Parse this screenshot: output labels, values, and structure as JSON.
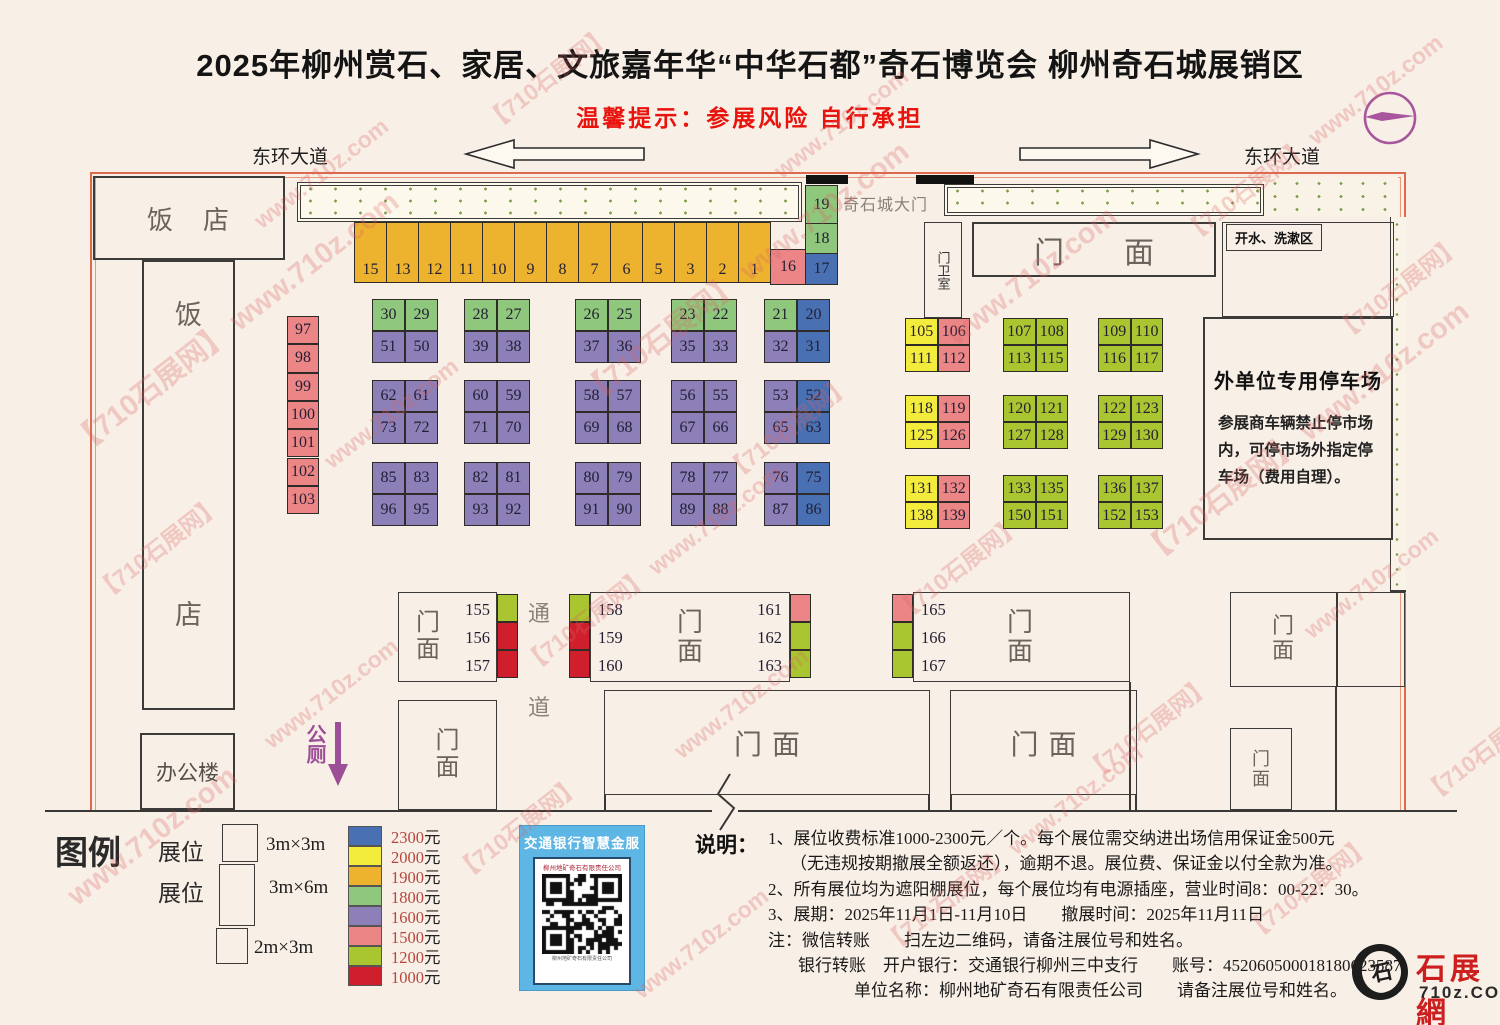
{
  "header": {
    "title": "2025年柳州赏石、家居、文旅嘉年华“中华石都”奇石博览会 柳州奇石城展销区",
    "subtitle": "温馨提示：参展风险 自行承担"
  },
  "roads": {
    "left": "东环大道",
    "right": "东环大道"
  },
  "labels": {
    "gate": "奇石城大门",
    "guard_room": "门卫室",
    "water_area": "开水、洗漱区",
    "men": "门",
    "mian": "面",
    "corridor_top": "通",
    "corridor_bottom": "道",
    "toilet": "公厕",
    "restaurant_fan": "饭",
    "restaurant_dian": "店",
    "restaurant_top": "饭　店",
    "office": "办公楼"
  },
  "parking": {
    "title": "外单位专用停车场",
    "body": "参展商车辆禁止停市场内，可停市场外指定停车场（费用自理）。"
  },
  "price_colors": {
    "2300": "#4a70b4",
    "2000": "#f3ec3d",
    "1900": "#edb32f",
    "1800": "#8fc77c",
    "1600": "#8d80b8",
    "1500": "#ec8686",
    "1200": "#a9c52f",
    "1000": "#d01f2c"
  },
  "booths": {
    "top_row": {
      "price": "1900",
      "numbers": [
        15,
        13,
        12,
        11,
        10,
        9,
        8,
        7,
        6,
        5,
        3,
        2,
        1
      ]
    },
    "corner": [
      {
        "n": 19,
        "p": "1800"
      },
      {
        "n": 18,
        "p": "1800"
      },
      {
        "n": 17,
        "p": "2300"
      },
      {
        "n": 16,
        "p": "1500"
      }
    ],
    "left_column": {
      "price": "1500",
      "numbers": [
        97,
        98,
        99,
        100,
        101,
        102,
        103
      ]
    },
    "center_blocks": [
      [
        [
          {
            "n": 30,
            "p": "1800"
          },
          {
            "n": 29,
            "p": "1800"
          },
          {
            "n": 51,
            "p": "1600"
          },
          {
            "n": 50,
            "p": "1600"
          }
        ],
        [
          {
            "n": 28,
            "p": "1800"
          },
          {
            "n": 27,
            "p": "1800"
          },
          {
            "n": 39,
            "p": "1600"
          },
          {
            "n": 38,
            "p": "1600"
          }
        ],
        [
          {
            "n": 26,
            "p": "1800"
          },
          {
            "n": 25,
            "p": "1800"
          },
          {
            "n": 37,
            "p": "1600"
          },
          {
            "n": 36,
            "p": "1600"
          }
        ],
        [
          {
            "n": 23,
            "p": "1800"
          },
          {
            "n": 22,
            "p": "1800"
          },
          {
            "n": 35,
            "p": "1600"
          },
          {
            "n": 33,
            "p": "1600"
          }
        ],
        [
          {
            "n": 21,
            "p": "1800"
          },
          {
            "n": 20,
            "p": "2300"
          },
          {
            "n": 32,
            "p": "1600"
          },
          {
            "n": 31,
            "p": "2300"
          }
        ]
      ],
      [
        [
          {
            "n": 62,
            "p": "1600"
          },
          {
            "n": 61,
            "p": "1600"
          },
          {
            "n": 73,
            "p": "1600"
          },
          {
            "n": 72,
            "p": "1600"
          }
        ],
        [
          {
            "n": 60,
            "p": "1600"
          },
          {
            "n": 59,
            "p": "1600"
          },
          {
            "n": 71,
            "p": "1600"
          },
          {
            "n": 70,
            "p": "1600"
          }
        ],
        [
          {
            "n": 58,
            "p": "1600"
          },
          {
            "n": 57,
            "p": "1600"
          },
          {
            "n": 69,
            "p": "1600"
          },
          {
            "n": 68,
            "p": "1600"
          }
        ],
        [
          {
            "n": 56,
            "p": "1600"
          },
          {
            "n": 55,
            "p": "1600"
          },
          {
            "n": 67,
            "p": "1600"
          },
          {
            "n": 66,
            "p": "1600"
          }
        ],
        [
          {
            "n": 53,
            "p": "1600"
          },
          {
            "n": 52,
            "p": "2300"
          },
          {
            "n": 65,
            "p": "1600"
          },
          {
            "n": 63,
            "p": "2300"
          }
        ]
      ],
      [
        [
          {
            "n": 85,
            "p": "1600"
          },
          {
            "n": 83,
            "p": "1600"
          },
          {
            "n": 96,
            "p": "1600"
          },
          {
            "n": 95,
            "p": "1600"
          }
        ],
        [
          {
            "n": 82,
            "p": "1600"
          },
          {
            "n": 81,
            "p": "1600"
          },
          {
            "n": 93,
            "p": "1600"
          },
          {
            "n": 92,
            "p": "1600"
          }
        ],
        [
          {
            "n": 80,
            "p": "1600"
          },
          {
            "n": 79,
            "p": "1600"
          },
          {
            "n": 91,
            "p": "1600"
          },
          {
            "n": 90,
            "p": "1600"
          }
        ],
        [
          {
            "n": 78,
            "p": "1600"
          },
          {
            "n": 77,
            "p": "1600"
          },
          {
            "n": 89,
            "p": "1600"
          },
          {
            "n": 88,
            "p": "1600"
          }
        ],
        [
          {
            "n": 76,
            "p": "1600"
          },
          {
            "n": 75,
            "p": "2300"
          },
          {
            "n": 87,
            "p": "1600"
          },
          {
            "n": 86,
            "p": "2300"
          }
        ]
      ]
    ],
    "right_blocks": [
      [
        [
          {
            "n": 105,
            "p": "2000"
          },
          {
            "n": 106,
            "p": "1500"
          },
          {
            "n": 111,
            "p": "2000"
          },
          {
            "n": 112,
            "p": "1500"
          }
        ],
        [
          {
            "n": 107,
            "p": "1200"
          },
          {
            "n": 108,
            "p": "1200"
          },
          {
            "n": 113,
            "p": "1200"
          },
          {
            "n": 115,
            "p": "1200"
          }
        ],
        [
          {
            "n": 109,
            "p": "1200"
          },
          {
            "n": 110,
            "p": "1200"
          },
          {
            "n": 116,
            "p": "1200"
          },
          {
            "n": 117,
            "p": "1200"
          }
        ]
      ],
      [
        [
          {
            "n": 118,
            "p": "2000"
          },
          {
            "n": 119,
            "p": "1500"
          },
          {
            "n": 125,
            "p": "2000"
          },
          {
            "n": 126,
            "p": "1500"
          }
        ],
        [
          {
            "n": 120,
            "p": "1200"
          },
          {
            "n": 121,
            "p": "1200"
          },
          {
            "n": 127,
            "p": "1200"
          },
          {
            "n": 128,
            "p": "1200"
          }
        ],
        [
          {
            "n": 122,
            "p": "1200"
          },
          {
            "n": 123,
            "p": "1200"
          },
          {
            "n": 129,
            "p": "1200"
          },
          {
            "n": 130,
            "p": "1200"
          }
        ]
      ],
      [
        [
          {
            "n": 131,
            "p": "2000"
          },
          {
            "n": 132,
            "p": "1500"
          },
          {
            "n": 138,
            "p": "2000"
          },
          {
            "n": 139,
            "p": "1500"
          }
        ],
        [
          {
            "n": 133,
            "p": "1200"
          },
          {
            "n": 135,
            "p": "1200"
          },
          {
            "n": 150,
            "p": "1200"
          },
          {
            "n": 151,
            "p": "1200"
          }
        ],
        [
          {
            "n": 136,
            "p": "1200"
          },
          {
            "n": 137,
            "p": "1200"
          },
          {
            "n": 152,
            "p": "1200"
          },
          {
            "n": 153,
            "p": "1200"
          }
        ]
      ]
    ]
  },
  "shops": {
    "row_a": {
      "numbers": [
        155,
        156,
        157
      ],
      "chips": [
        "1200",
        "1000",
        "1000"
      ]
    },
    "row_b_left": {
      "numbers": [
        158,
        159,
        160
      ],
      "chips": [
        "1200",
        "1000",
        "1000"
      ]
    },
    "row_b_right": {
      "numbers": [
        161,
        162,
        163
      ],
      "chips": [
        "1500",
        "1200",
        "1200"
      ]
    },
    "row_c": {
      "numbers": [
        165,
        166,
        167
      ],
      "chips": [
        "1500",
        "1200",
        "1200"
      ]
    }
  },
  "legend": {
    "title": "图例",
    "sizes": [
      {
        "label": "展位",
        "dims": "3m×3m"
      },
      {
        "label": "展位",
        "dims": "3m×6m"
      },
      {
        "label": "",
        "dims": "2m×3m"
      }
    ],
    "prices": [
      {
        "value": "2300",
        "unit": "元",
        "price": "2300"
      },
      {
        "value": "2000",
        "unit": "元",
        "price": "2000"
      },
      {
        "value": "1900",
        "unit": "元",
        "price": "1900"
      },
      {
        "value": "1800",
        "unit": "元",
        "price": "1800"
      },
      {
        "value": "1600",
        "unit": "元",
        "price": "1600"
      },
      {
        "value": "1500",
        "unit": "元",
        "price": "1500"
      },
      {
        "value": "1200",
        "unit": "元",
        "price": "1200"
      },
      {
        "value": "1000",
        "unit": "元",
        "price": "1000"
      }
    ]
  },
  "qr": {
    "header": "交通银行智慧金服",
    "company": "柳州地矿奇石有限责任公司",
    "caption": "柳州地矿奇石有限责任公司"
  },
  "notes": {
    "heading": "说明：",
    "lines": [
      "1、展位收费标准1000-2300元／个。每个展位需交纳进出场信用保证金500元",
      "（无违规按期撤展全额返还），逾期不退。展位费、保证金以付全款为准。",
      "2、所有展位均为遮阳棚展位，每个展位均有电源插座，营业时间8：00-22：30。",
      "3、展期：2025年11月1日-11月10日　　撤展时间：2025年11月11日",
      "注：微信转账　　扫左边二维码，请备注展位号和姓名。",
      "银行转账　开户银行：交通银行柳州三中支行　　账号：452060500018180623587",
      "单位名称：柳州地矿奇石有限责任公司　　请备注展位号和姓名。"
    ]
  },
  "site_logo": {
    "glyph": "石",
    "name": "石展網",
    "domain": "710z.COM"
  },
  "watermark": {
    "tag": "【710石展网】",
    "url": "www.710z.com"
  }
}
